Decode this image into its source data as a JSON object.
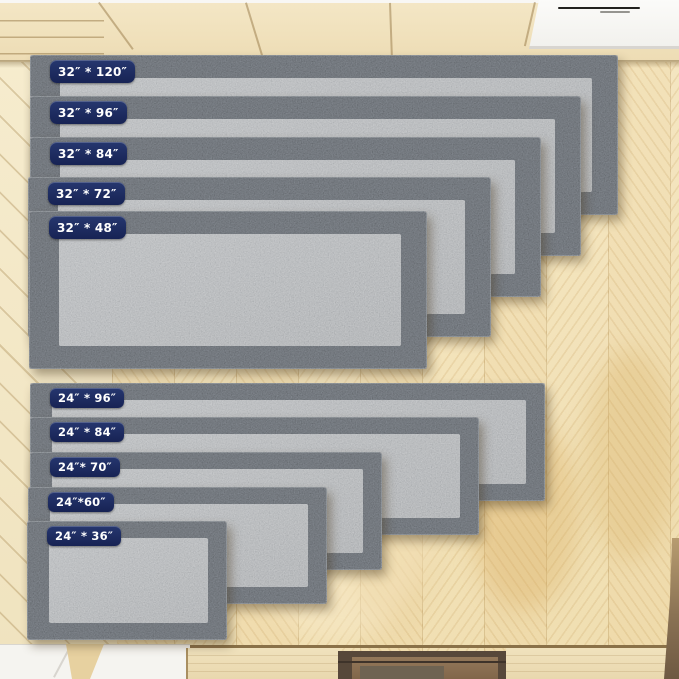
{
  "product": {
    "groups": [
      {
        "id": "runners-32-inch",
        "rugs": [
          {
            "label": "32″ * 120″",
            "width_in": 32,
            "length_in": 120
          },
          {
            "label": "32″ * 96″",
            "width_in": 32,
            "length_in": 96
          },
          {
            "label": "32″ * 84″",
            "width_in": 32,
            "length_in": 84
          },
          {
            "label": "32″ * 72″",
            "width_in": 32,
            "length_in": 72
          },
          {
            "label": "32″ * 48″",
            "width_in": 32,
            "length_in": 48
          }
        ]
      },
      {
        "id": "runners-24-inch",
        "rugs": [
          {
            "label": "24″ * 96″",
            "width_in": 24,
            "length_in": 96
          },
          {
            "label": "24″ * 84″",
            "width_in": 24,
            "length_in": 84
          },
          {
            "label": "24″* 70″",
            "width_in": 24,
            "length_in": 70
          },
          {
            "label": "24″*60″",
            "width_in": 24,
            "length_in": 60
          },
          {
            "label": "24″ * 36″",
            "width_in": 24,
            "length_in": 36
          }
        ]
      }
    ]
  },
  "colors": {
    "badge_bg": "#1c2a5c",
    "badge_text": "#ffffff",
    "rug_border_gray": "#5d6166",
    "rug_pile_gray": "#a3a6a9",
    "floor_wood": "#f2e4c0",
    "cabinet_wood": "#f1e3c0",
    "counter_white": "#fafaf8",
    "recess_brown": "#8b7251"
  }
}
